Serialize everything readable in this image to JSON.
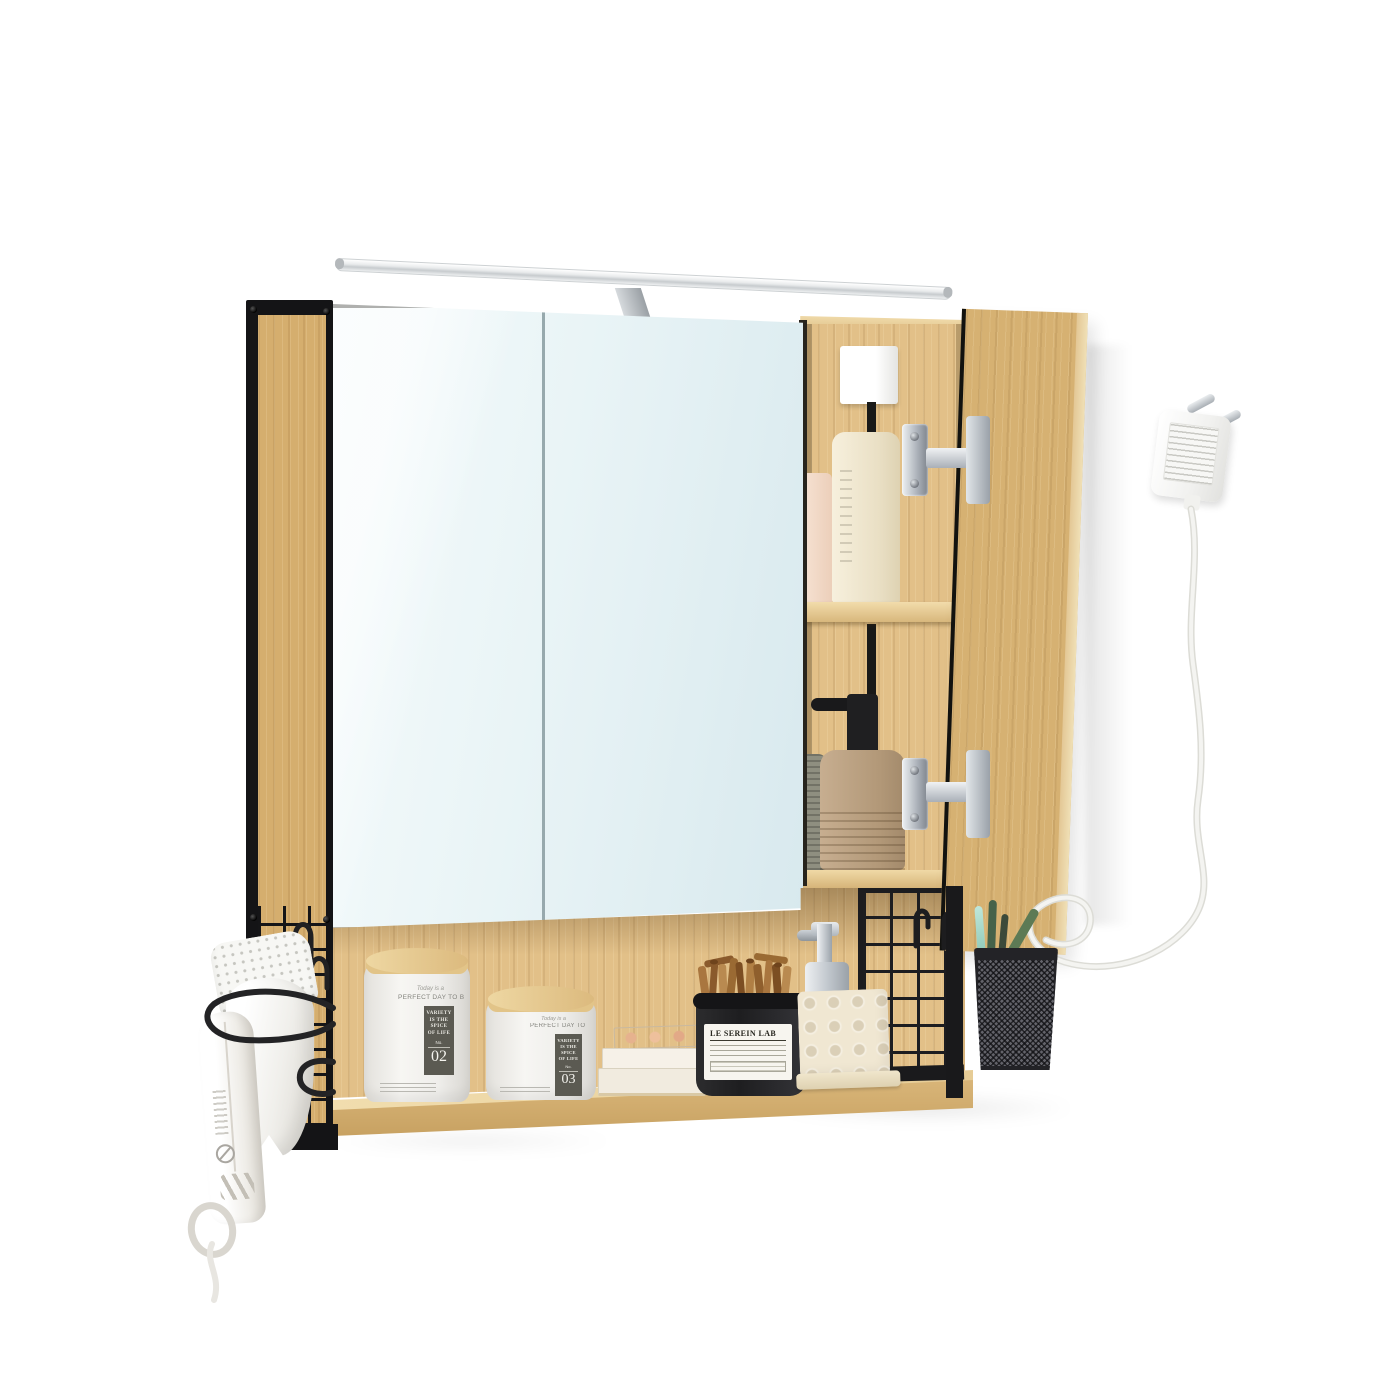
{
  "scene": {
    "type": "product-photo",
    "background": "#ffffff",
    "description": "Wall-mounted bathroom mirror cabinet in oak finish with black steel mesh frame; LED light bar on top; right mirror door open showing two shelf levels with a white box, bottles and a stone soap dispenser; open lower shelf styled with canisters, a black candle jar with cinnamon sticks, stacked palettes, a chrome soap pump and a dimpled soap stand; mesh toothbrush basket on the right; white hair dryer in a black wire holder on the left; white power adapter with looping cable hanging at the right."
  },
  "palette": {
    "wood": "#d8b274",
    "wood_light": "#eed9a8",
    "wood_back": "#e2c088",
    "wood_edge": "#f0e0b6",
    "frame_black": "#1b1b1d",
    "mirror_tint": "#e3f0f3",
    "chrome": "#b9bfc7",
    "cream": "#f1e9d3",
    "stone": "#bda387",
    "cable_white": "#f1f1ee"
  },
  "labels": {
    "canister_large": {
      "script": "Today is a",
      "headline": "PERFECT DAY TO BE HAPPY",
      "block_lines": [
        "VARIETY",
        "IS THE",
        "SPICE",
        "OF LIFE"
      ],
      "no_label": "No.",
      "number": "02"
    },
    "canister_small": {
      "script": "Today is a",
      "headline": "PERFECT DAY TO BE HAPPY",
      "block_lines": [
        "VARIETY",
        "IS THE",
        "SPICE",
        "OF LIFE"
      ],
      "no_label": "No.",
      "number": "03"
    },
    "candle_jar": {
      "brand": "LE SEREIN LAB"
    }
  }
}
